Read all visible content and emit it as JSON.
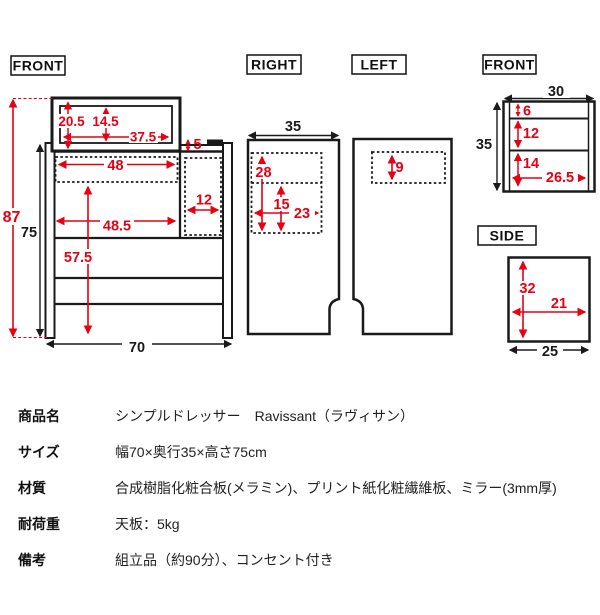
{
  "colors": {
    "dimension_red": "#e60012",
    "line_black": "#1a1a1a"
  },
  "views": {
    "front_main": {
      "label": "FRONT",
      "dims": {
        "total_height": "87",
        "body_height": "75",
        "mirror_frame_height": "20.5",
        "mirror_height": "14.5",
        "mirror_width": "37.5",
        "outlet_ledge_height": "5",
        "top_compartment_width": "48",
        "side_compartment_width": "12",
        "open_space_width": "48.5",
        "open_space_height": "57.5",
        "total_width": "70"
      }
    },
    "right": {
      "label": "RIGHT",
      "dims": {
        "depth": "35",
        "upper_inner_height": "28",
        "lower_inner_height": "15",
        "inner_depth": "23"
      }
    },
    "left": {
      "label": "LEFT",
      "dims": {
        "slot_height": "9"
      }
    },
    "front_drawers": {
      "label": "FRONT",
      "dims": {
        "width": "30",
        "height": "35",
        "top_row_height": "6",
        "middle_row_height": "12",
        "bottom_row_height": "14",
        "inner_width": "26.5"
      }
    },
    "side_drawers": {
      "label": "SIDE",
      "dims": {
        "inner_height": "32",
        "inner_width": "21",
        "depth": "25"
      }
    }
  },
  "spec_table": {
    "rows": [
      {
        "label": "商品名",
        "value": "シンプルドレッサー　Ravissant（ラヴィサン）"
      },
      {
        "label": "サイズ",
        "value": "幅70×奥行35×高さ75cm"
      },
      {
        "label": "材質",
        "value": "合成樹脂化粧合板(メラミン)、プリント紙化粧繊維板、ミラー(3mm厚)"
      },
      {
        "label": "耐荷重",
        "value": "天板：5kg"
      },
      {
        "label": "備考",
        "value": "組立品（約90分）、コンセント付き"
      }
    ]
  }
}
